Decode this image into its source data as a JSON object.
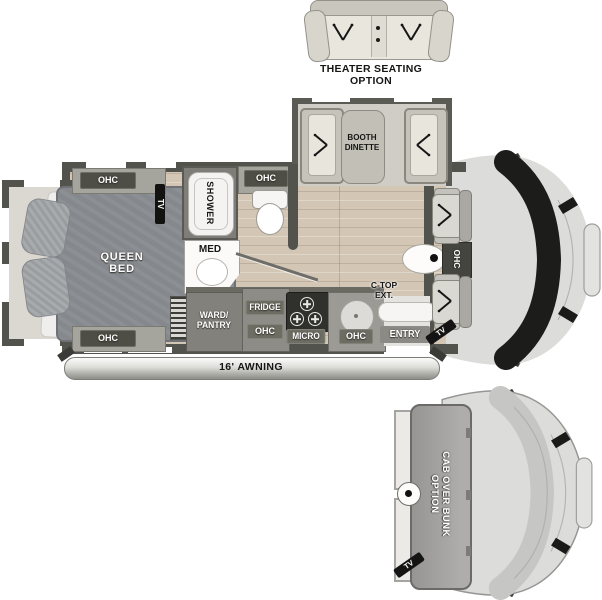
{
  "theater": {
    "caption1": "THEATER SEATING",
    "caption2": "OPTION"
  },
  "dinette": {
    "label1": "BOOTH",
    "label2": "DINETTE"
  },
  "bedroom": {
    "bed1": "QUEEN",
    "bed2": "BED",
    "ohc_top": "OHC",
    "ohc_bottom": "OHC",
    "tv": "TV"
  },
  "bath": {
    "shower": "SHOWER",
    "med": "MED",
    "ohc": "OHC"
  },
  "kitchen": {
    "ward1": "WARD/",
    "ward2": "PANTRY",
    "fridge": "FRIDGE",
    "fridge_ohc": "OHC",
    "micro": "MICRO",
    "sink_ohc": "OHC",
    "ctop1": "C-TOP",
    "ctop2": "EXT.",
    "entry": "ENTRY"
  },
  "front": {
    "ohc": "OHC",
    "tv": "TV"
  },
  "awning": {
    "label": "16' AWNING"
  },
  "bunk": {
    "label1": "CAB OVER BUNK",
    "label2": "OPTION",
    "tv": "TV"
  },
  "colors": {
    "wall": "#53534d",
    "wood_floor": "#d3c6b5",
    "bed": "#85888c",
    "cab_body": "#dcdcda",
    "windshield": "#1c1c1a",
    "label_chip": "#4e4e46"
  }
}
